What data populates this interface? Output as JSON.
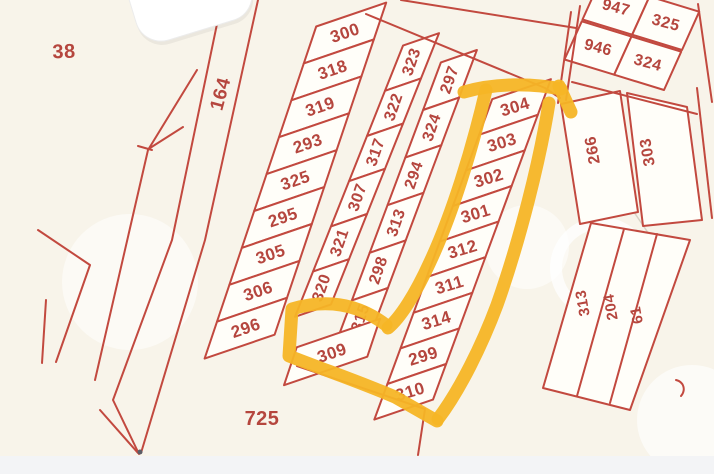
{
  "map": {
    "background_label_left": "38",
    "strip_label": "164",
    "bottom_label": "725",
    "main_grid": {
      "col1": [
        "300",
        "318",
        "319",
        "293",
        "325",
        "295",
        "305",
        "306",
        "296"
      ],
      "col2": [
        "323",
        "322",
        "317",
        "307",
        "321",
        "320"
      ],
      "col3": [
        "297",
        "324",
        "294",
        "313",
        "298",
        "315"
      ],
      "col4": [
        "304",
        "303",
        "302",
        "301",
        "312",
        "311",
        "314",
        "299",
        "310"
      ],
      "detached": "309"
    },
    "top_right_block": [
      "947",
      "325",
      "946",
      "324"
    ],
    "right_block": [
      "266",
      "303"
    ],
    "bottom_right_strips": [
      "313",
      "204",
      "61"
    ],
    "highlighted_parcels": [
      "304",
      "303",
      "302",
      "301",
      "312",
      "311",
      "314",
      "299",
      "310",
      "309"
    ],
    "colors": {
      "line": "#c2493f",
      "label": "#b5463e",
      "highlight": "#f5b526",
      "background": "#f8f4ea",
      "cell": "#fffef9",
      "bottom_strip": "#f3f4f6"
    }
  }
}
